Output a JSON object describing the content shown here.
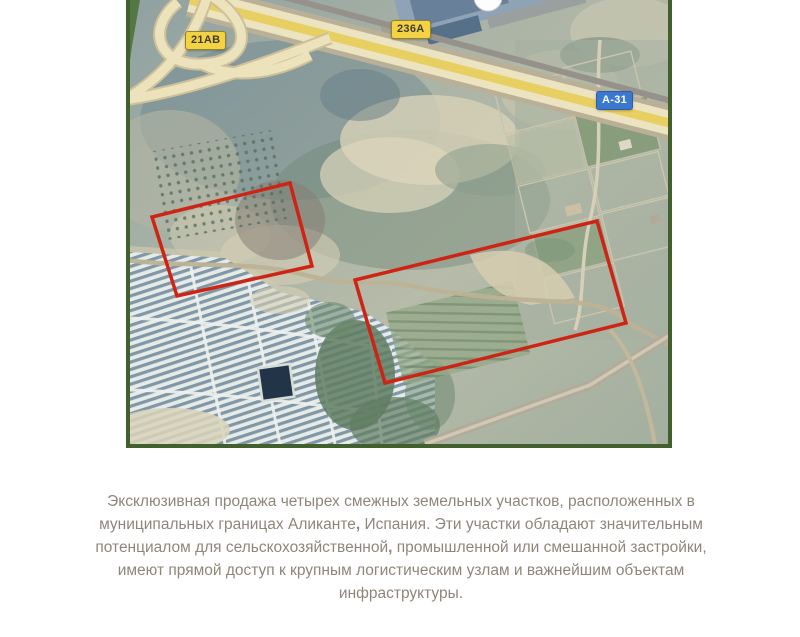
{
  "map": {
    "road_labels": [
      {
        "id": "21AB",
        "text": "21AB",
        "style": "yellow-shield"
      },
      {
        "id": "236A",
        "text": "236A",
        "style": "yellow-shield"
      },
      {
        "id": "A-31",
        "text": "A-31",
        "style": "blue-shield"
      }
    ],
    "parcels": [
      {
        "name": "parcel-west",
        "points": "160,183 22,217 47,296 182,266"
      },
      {
        "name": "parcel-east",
        "points": "225,280 467,221 496,323 255,383"
      }
    ]
  },
  "description": {
    "segments": [
      {
        "text": "Эксклюзивная продажа четырех смежных земельных участков, расположенных в муниципальных границах Аликанте",
        "bold": false
      },
      {
        "text": ",",
        "bold": true
      },
      {
        "text": " Испания. Эти участки обладают значительным потенциалом для сельскохозяйственной",
        "bold": false
      },
      {
        "text": ",",
        "bold": true
      },
      {
        "text": " промышленной или смешанной застройки, имеют прямой доступ к крупным логистическим узлам и важнейшим объектам инфраструктуры.",
        "bold": false
      }
    ]
  },
  "colors": {
    "map_border": "#41602d",
    "parcel_outline": "#ce2415",
    "badge_yellow_bg": "#f3d243",
    "badge_yellow_border": "#93832a",
    "badge_yellow_text": "#3f3e33",
    "badge_blue_bg": "#3a78cf",
    "badge_blue_text": "#ffffff",
    "body_text": "#8f867a"
  }
}
